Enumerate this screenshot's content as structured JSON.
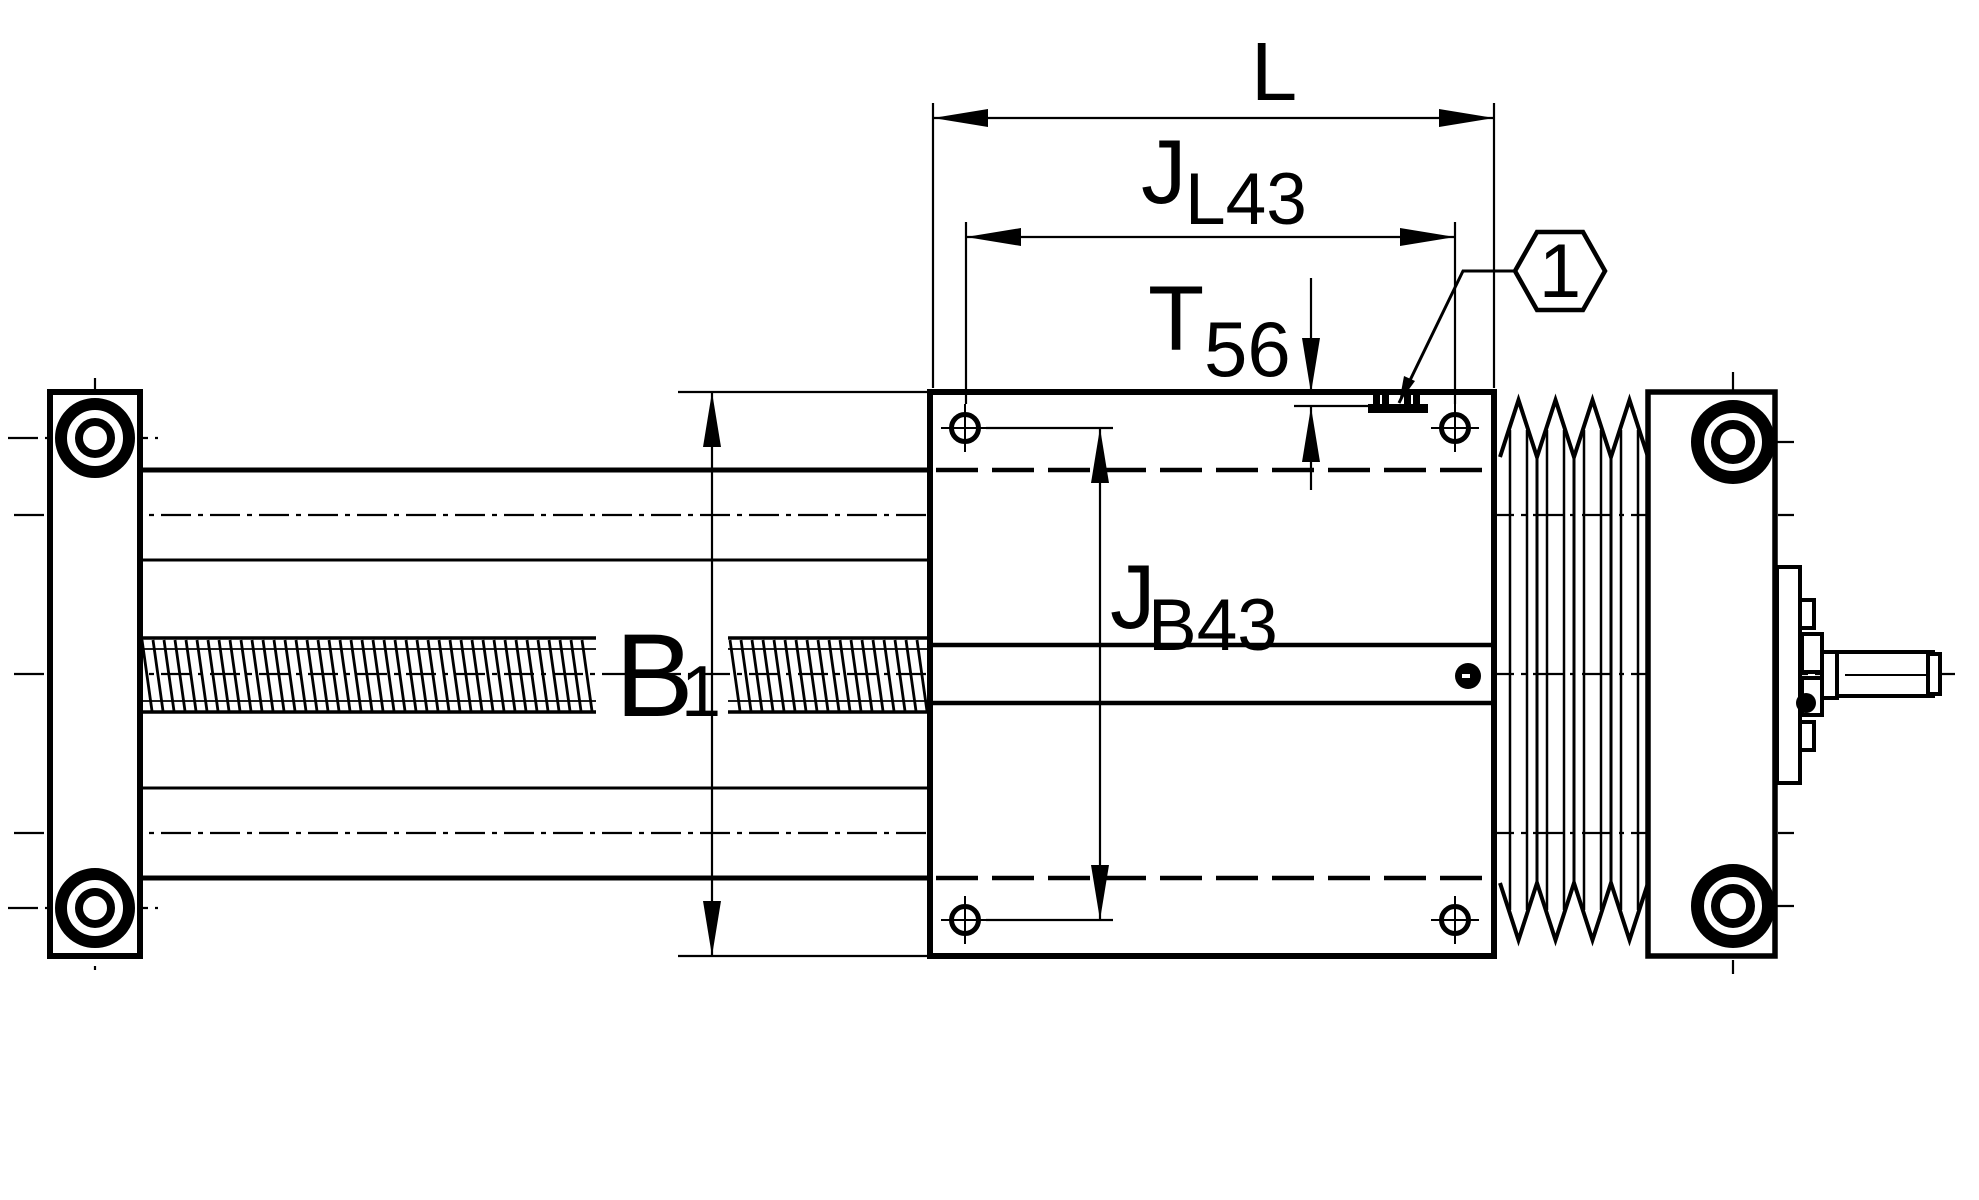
{
  "drawing": {
    "colors": {
      "line": "#000000",
      "background": "#ffffff"
    },
    "dimensions": {
      "overall_length": {
        "main": "L",
        "sub": ""
      },
      "hole_spacing_long": {
        "main": "J",
        "sub": "L43"
      },
      "tslot_depth": {
        "main": "T",
        "sub": "56"
      },
      "hole_spacing_cross": {
        "main": "J",
        "sub": "B43"
      },
      "unit_width": {
        "main": "B",
        "sub": "1"
      }
    },
    "callouts": {
      "balloon_1": "1"
    }
  }
}
